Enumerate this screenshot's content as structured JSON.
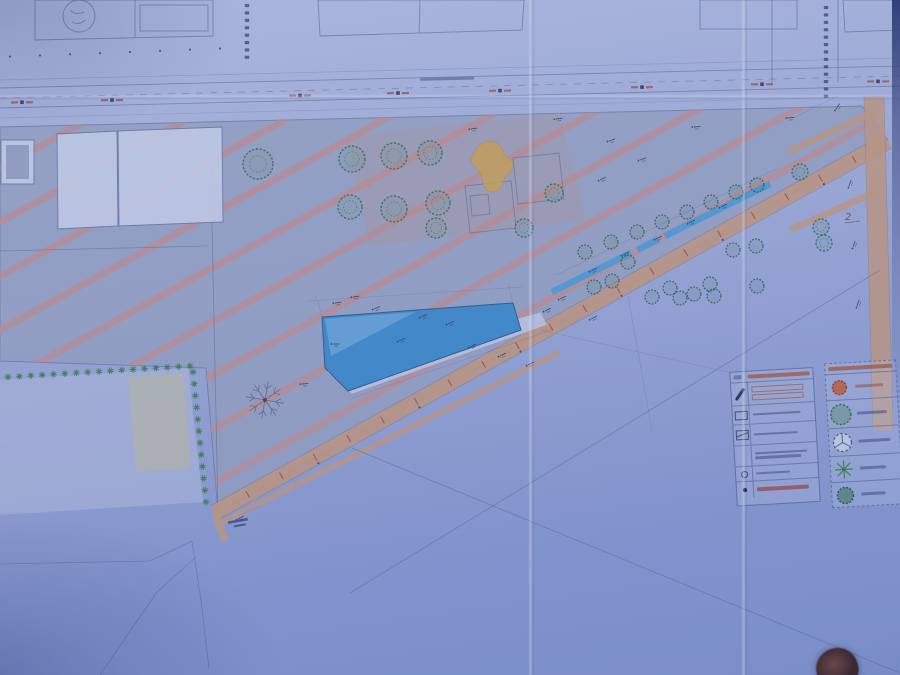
{
  "palette": {
    "paper_blue_cast": "#8fa0d2",
    "site_grey": "#98a3c2",
    "stripe_pink": "#c98f8c",
    "promenade_tan": "#c79a7c",
    "pool_blue": "#3e8ed0",
    "channel_blue": "#4aa0dc",
    "tree_green": "#2e6b52",
    "hedge_green": "#2f7f3f",
    "yellow_play_area": "#d2a447",
    "court_line": "#5f6f9f",
    "legend_header": "#a85a3f",
    "road_marker_red": "#b05a4a",
    "finger_brown": "#53322f"
  },
  "plan": {
    "zone_label": "2",
    "stripe_intercepts": [
      168,
      222,
      276,
      330,
      384,
      438,
      492,
      546,
      600
    ],
    "road_marker_x": [
      22,
      112,
      300,
      398,
      500,
      642,
      762,
      878
    ],
    "promenade": {
      "x1": 214,
      "y1": 513,
      "x2": 888,
      "y2": 141,
      "ticks": 20
    },
    "branch_tree": {
      "x": 265,
      "y": 400,
      "r": 19
    },
    "frontage_dots": {
      "n": 8
    },
    "vtexts": [
      {
        "x": 247,
        "y": 4,
        "n": 8
      },
      {
        "x": 826,
        "y": 6,
        "n": 13
      }
    ],
    "trees_large": [
      [
        258,
        164,
        15
      ],
      [
        352,
        159,
        13
      ],
      [
        394,
        156,
        13
      ],
      [
        430,
        153,
        12
      ],
      [
        350,
        207,
        12
      ],
      [
        394,
        209,
        13
      ],
      [
        438,
        203,
        12
      ],
      [
        436,
        228,
        10
      ],
      [
        524,
        228,
        9
      ],
      [
        554,
        193,
        9
      ],
      [
        800,
        172,
        8
      ],
      [
        821,
        227,
        8
      ],
      [
        824,
        243,
        8
      ]
    ],
    "trees_small": [
      [
        585,
        252
      ],
      [
        611,
        242
      ],
      [
        637,
        232
      ],
      [
        662,
        222
      ],
      [
        687,
        212
      ],
      [
        711,
        202
      ],
      [
        736,
        192
      ],
      [
        757,
        185
      ],
      [
        628,
        262
      ],
      [
        594,
        287
      ],
      [
        612,
        281
      ],
      [
        652,
        297
      ],
      [
        670,
        288
      ],
      [
        680,
        298
      ],
      [
        694,
        294
      ],
      [
        710,
        284
      ],
      [
        714,
        296
      ],
      [
        733,
        250
      ],
      [
        756,
        246
      ],
      [
        757,
        286
      ]
    ],
    "hedge_segments": [
      {
        "x1": 8,
        "y1": 377,
        "x2": 190,
        "y2": 366,
        "n": 17
      },
      {
        "x1": 193,
        "y1": 372,
        "x2": 206,
        "y2": 502,
        "n": 12
      }
    ],
    "annotation_marks": [
      [
        335,
        303,
        -8
      ],
      [
        353,
        297,
        -8
      ],
      [
        374,
        309,
        -22
      ],
      [
        421,
        317,
        -24
      ],
      [
        448,
        324,
        -24
      ],
      [
        333,
        344,
        0
      ],
      [
        399,
        341,
        -24
      ],
      [
        470,
        347,
        -27
      ],
      [
        500,
        356,
        -27
      ],
      [
        528,
        365,
        -27
      ],
      [
        302,
        384,
        -5
      ],
      [
        238,
        519,
        -27
      ],
      [
        560,
        299,
        -27
      ],
      [
        591,
        271,
        -27
      ],
      [
        623,
        255,
        -27
      ],
      [
        656,
        239,
        -27
      ],
      [
        689,
        223,
        -27
      ],
      [
        721,
        207,
        -27
      ],
      [
        591,
        319,
        -27
      ],
      [
        545,
        311,
        -27
      ],
      [
        471,
        129,
        -8
      ],
      [
        556,
        119,
        -8
      ],
      [
        609,
        141,
        -20
      ],
      [
        694,
        127,
        -5
      ],
      [
        788,
        118,
        -5
      ],
      [
        836,
        109,
        -55
      ],
      [
        849,
        186,
        -70
      ],
      [
        853,
        247,
        -70
      ],
      [
        857,
        306,
        -70
      ],
      [
        600,
        180,
        -27
      ],
      [
        640,
        160,
        -20
      ]
    ]
  },
  "legend": {
    "left_table": {
      "rows": [
        {
          "symbol": "slope-line-icon",
          "label": ""
        },
        {
          "symbol": "rect-outline-icon",
          "label": ""
        },
        {
          "symbol": "hatched-rect-icon",
          "label": ""
        },
        {
          "symbol": "text-only",
          "label": ""
        },
        {
          "symbol": "small-circle-icon",
          "label": ""
        },
        {
          "symbol": "black-dot-icon",
          "label": ""
        }
      ]
    },
    "right_table": {
      "rows": [
        {
          "symbol": "tree-red-icon",
          "label": ""
        },
        {
          "symbol": "tree-green-large-icon",
          "label": ""
        },
        {
          "symbol": "tree-outline-icon",
          "label": ""
        },
        {
          "symbol": "shrub-star-icon",
          "label": ""
        },
        {
          "symbol": "tree-dark-green-icon",
          "label": ""
        }
      ]
    }
  }
}
